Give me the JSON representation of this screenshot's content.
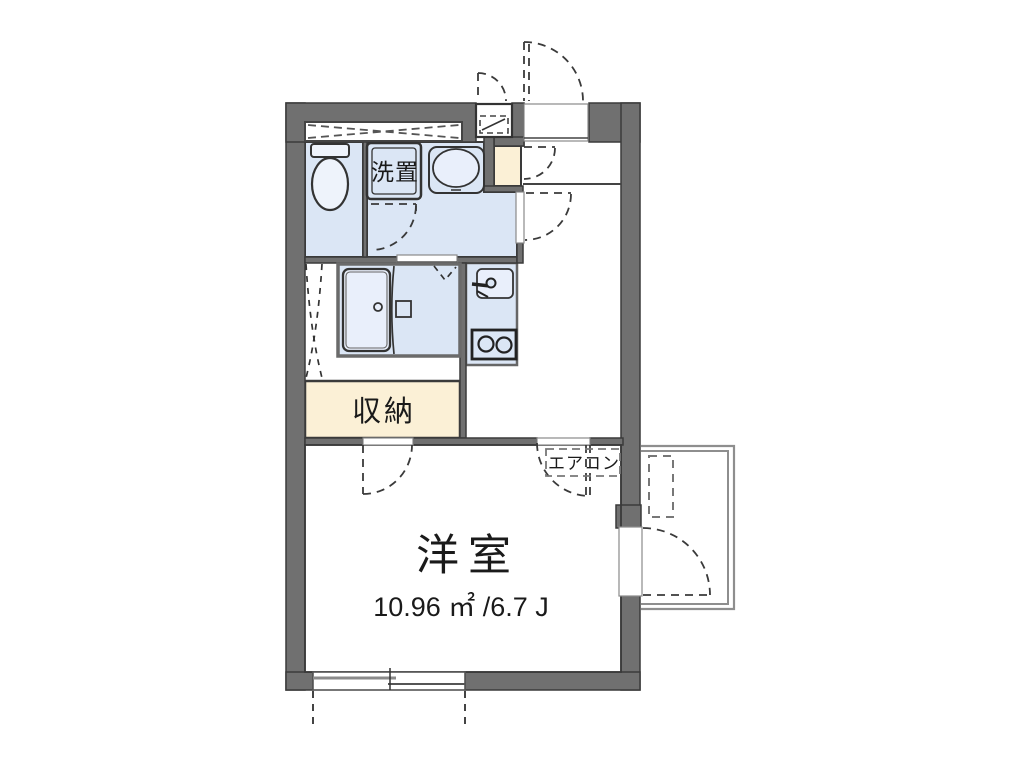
{
  "plan": {
    "labels": {
      "washer": "洗置",
      "storage": "収納",
      "room": "洋室",
      "room_area": "10.96 ㎡ /6.7 J",
      "aircon": "エアコン"
    },
    "colors": {
      "wall": "#707070",
      "water": "#dbe6f5",
      "water_light": "#e9effb",
      "storage": "#fbf0d6",
      "line": "#3a3a3a",
      "frame": "#6a6a6a",
      "balcony": "#8e8e8e"
    }
  }
}
